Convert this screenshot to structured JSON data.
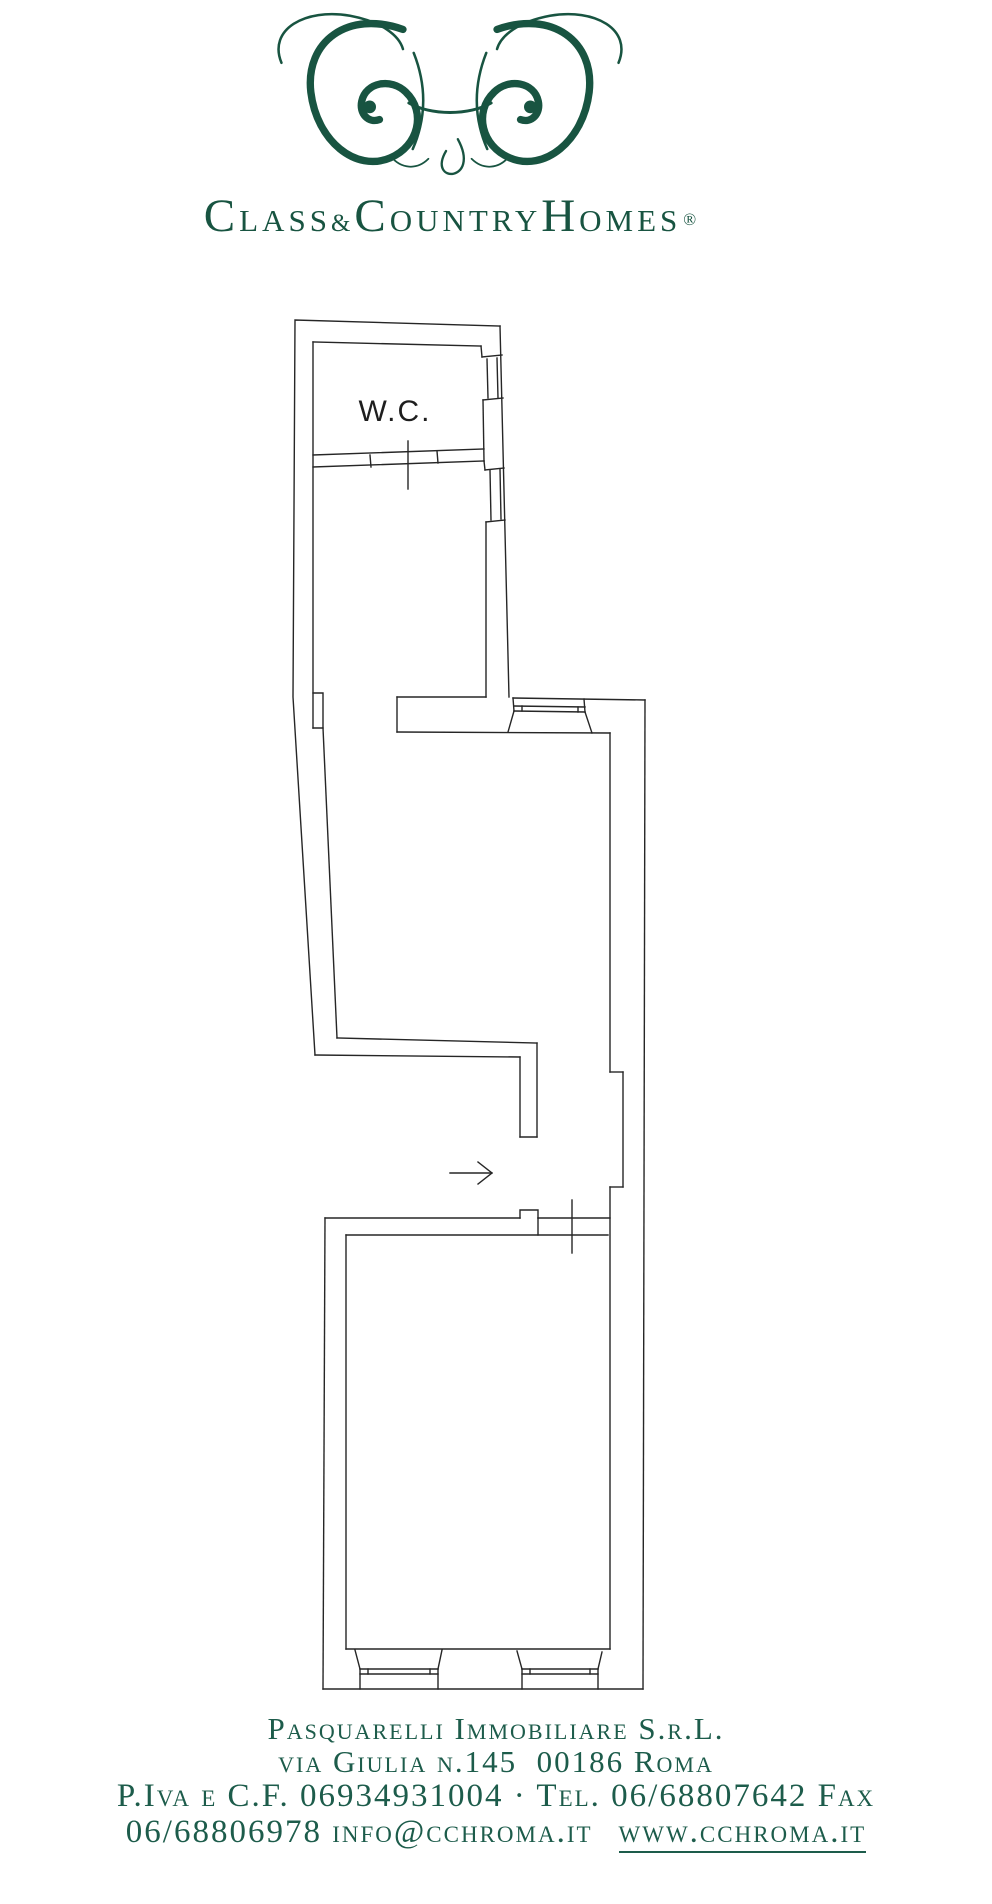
{
  "brand": {
    "color": "#185441",
    "monogram_name": "class-country-homes-monogram",
    "word_c1": "C",
    "word_lass": "LASS",
    "word_amp": "&",
    "word_c2": "C",
    "word_ountry": "OUNTRY",
    "word_h": "H",
    "word_omes": "OMES",
    "word_reg": "®"
  },
  "floorplan": {
    "wc_label": "W.C.",
    "line_color": "#262626",
    "symbols": [
      "entrance-arrow",
      "door-mark",
      "window"
    ]
  },
  "footer": {
    "line1": "Pasquarelli Immobiliare S.r.L.",
    "line2": "via Giulia n.145  00186 Roma",
    "line3": "P.Iva e C.F. 06934931004 · Tel. 06/68807642 Fax",
    "line4_prefix": "06/68806978 info@cchroma.it",
    "line4_link": "www.cchroma.it"
  }
}
